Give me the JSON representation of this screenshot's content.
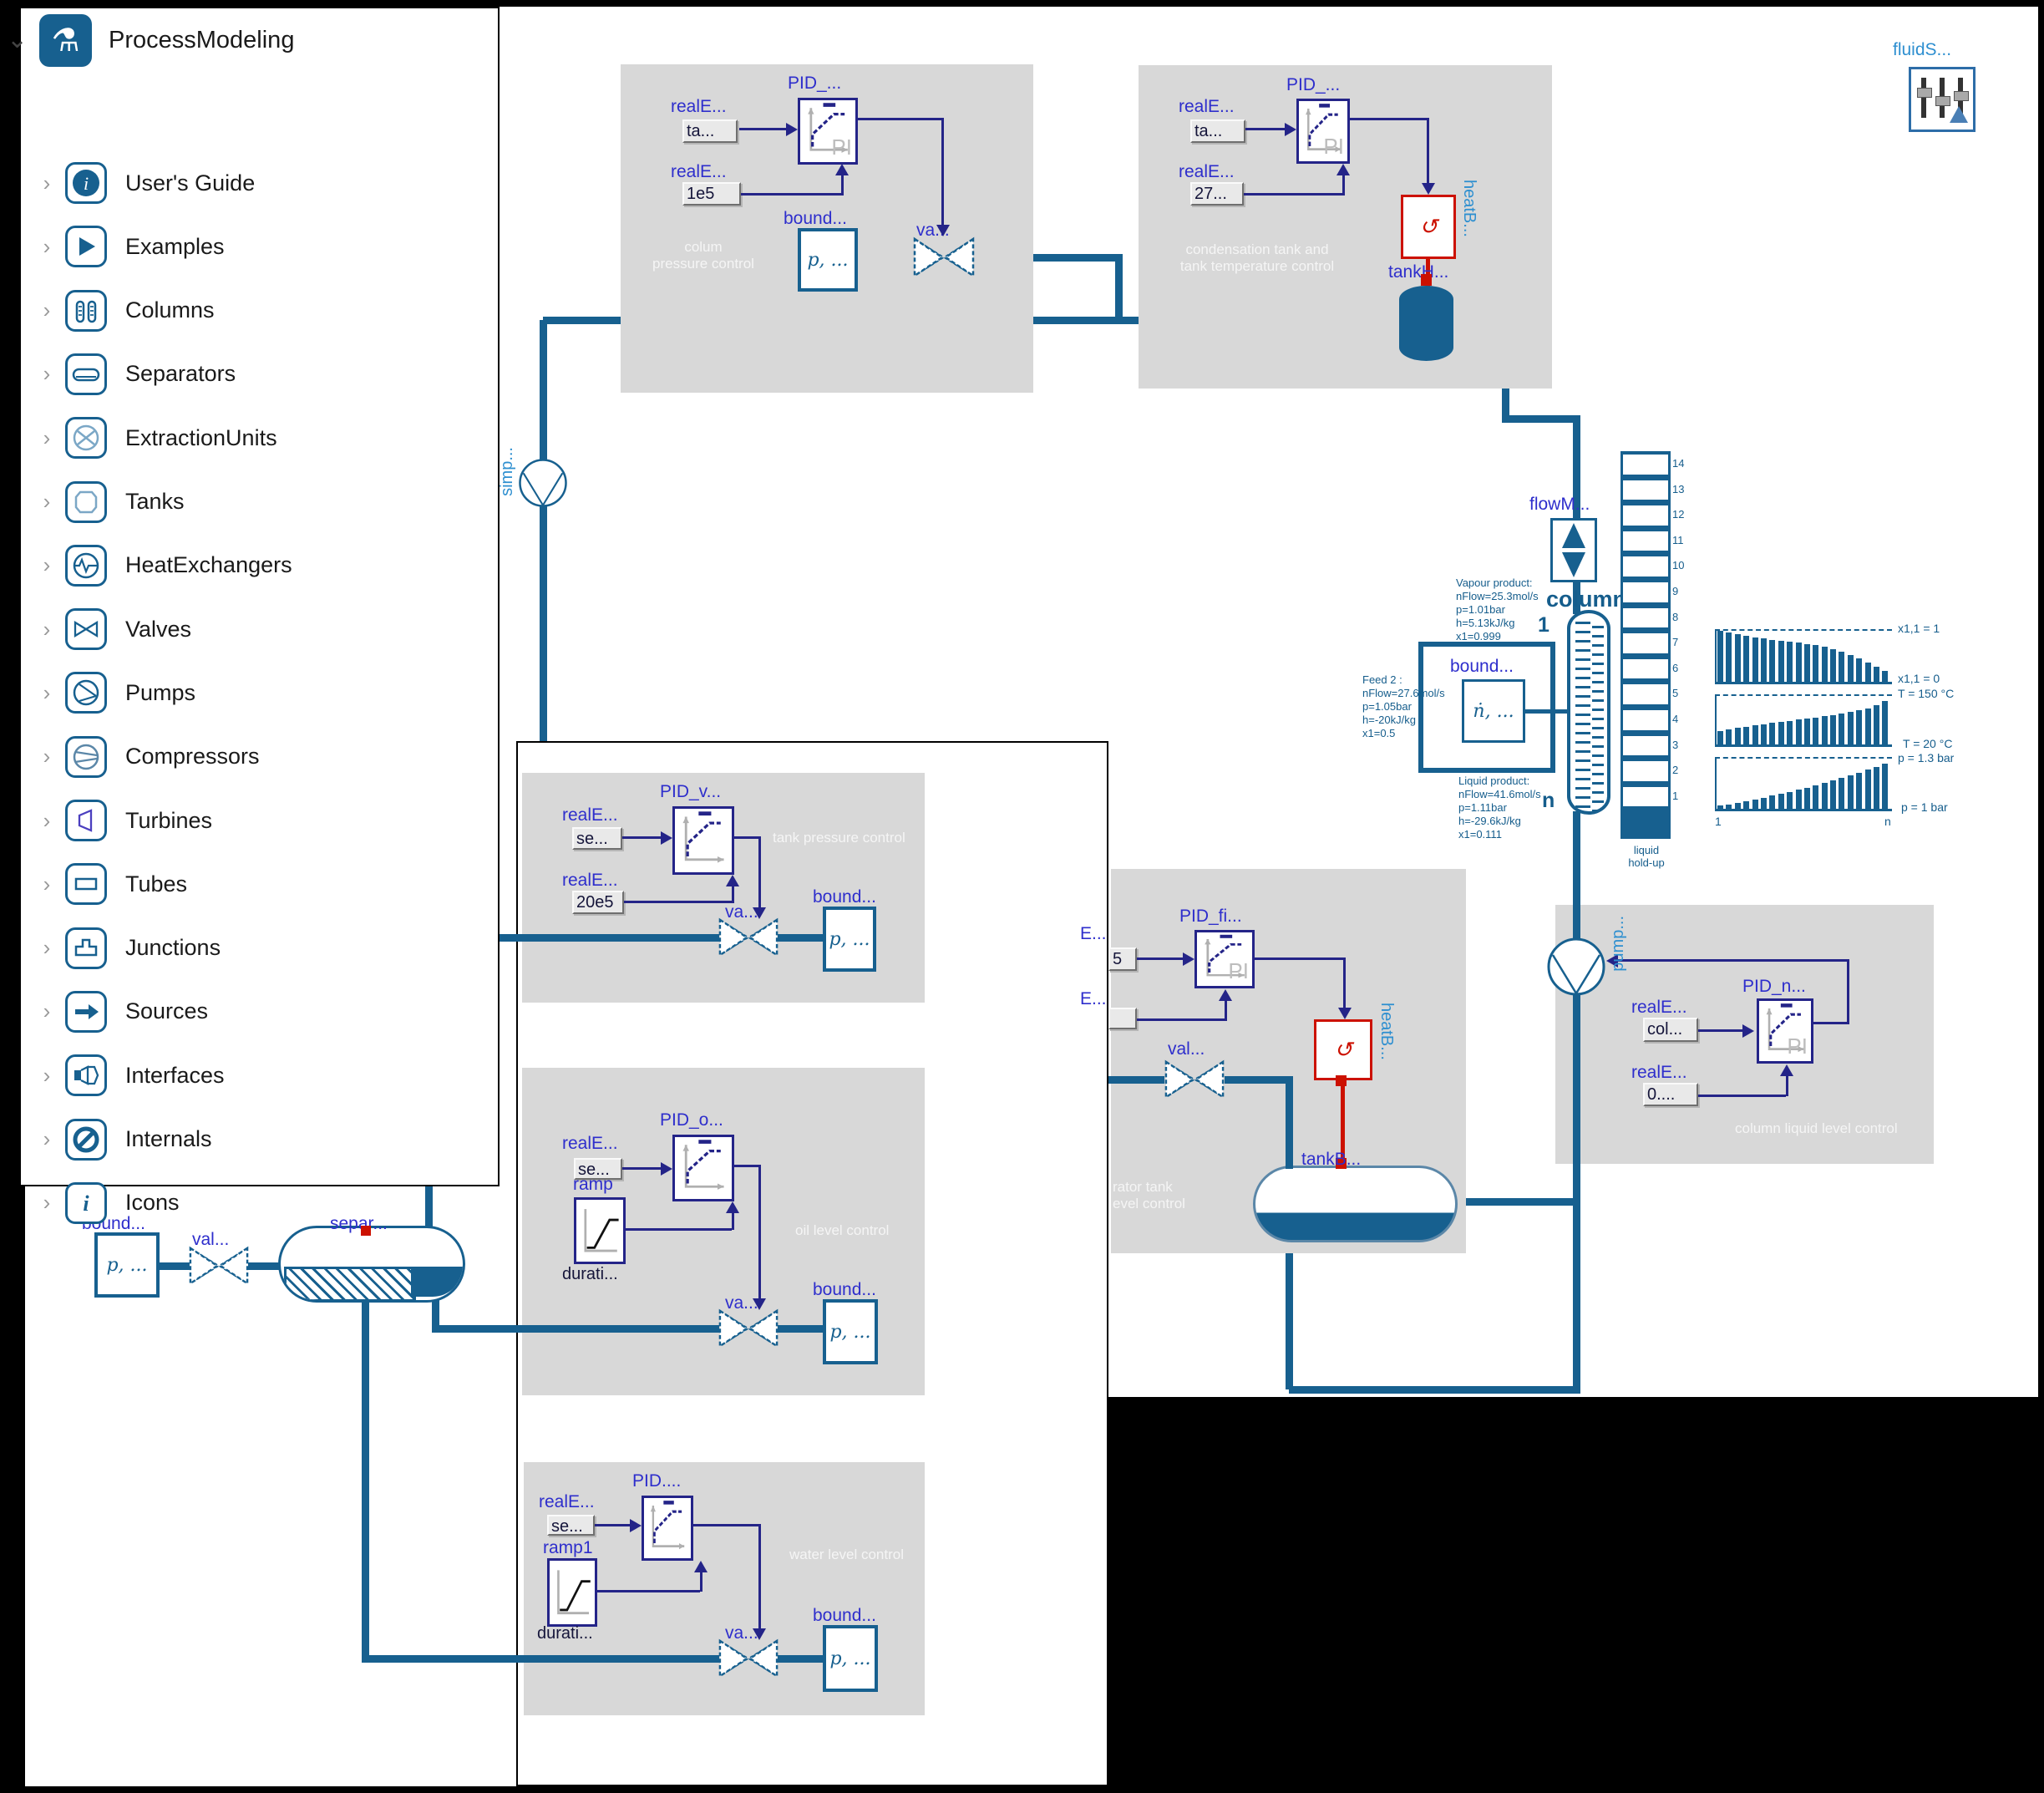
{
  "sidebar": {
    "root_label": "ProcessModeling",
    "items": [
      {
        "label": "User's Guide",
        "icon": "info-icon"
      },
      {
        "label": "Examples",
        "icon": "play-icon"
      },
      {
        "label": "Columns",
        "icon": "columns-icon"
      },
      {
        "label": "Separators",
        "icon": "separator-icon"
      },
      {
        "label": "ExtractionUnits",
        "icon": "extraction-icon"
      },
      {
        "label": "Tanks",
        "icon": "tank-icon"
      },
      {
        "label": "HeatExchangers",
        "icon": "heat-exchanger-icon"
      },
      {
        "label": "Valves",
        "icon": "valve-icon"
      },
      {
        "label": "Pumps",
        "icon": "pump-icon"
      },
      {
        "label": "Compressors",
        "icon": "compressor-icon"
      },
      {
        "label": "Turbines",
        "icon": "turbine-icon"
      },
      {
        "label": "Tubes",
        "icon": "tube-icon"
      },
      {
        "label": "Junctions",
        "icon": "junction-icon"
      },
      {
        "label": "Sources",
        "icon": "source-icon"
      },
      {
        "label": "Interfaces",
        "icon": "interface-icon"
      },
      {
        "label": "Internals",
        "icon": "internal-icon"
      },
      {
        "label": "Icons",
        "icon": "italic-i-icon"
      }
    ]
  },
  "fluid_source": {
    "label": "fluidS..."
  },
  "recycle_pump": {
    "label": "simp..."
  },
  "boxes": {
    "column_pressure": {
      "title_line1": "colum",
      "title_line2": "pressure control",
      "set_label": "realE...",
      "set_value": "ta...",
      "ref_label": "realE...",
      "ref_value": "1e5",
      "pid_label": "PID_...",
      "pid_inner": "PI",
      "bound_label": "bound...",
      "bound_value": "p, ...",
      "valve_label": "va..."
    },
    "condensation": {
      "title_line1": "condensation tank and",
      "title_line2": "tank temperature control",
      "set_label": "realE...",
      "set_value": "ta...",
      "ref_label": "realE...",
      "ref_value": "27...",
      "pid_label": "PID_...",
      "pid_inner": "PI",
      "heater_label": "heatB...",
      "tank_label": "tankH..."
    },
    "tank_pressure": {
      "title": "tank pressure control",
      "set_label": "realE...",
      "set_value": "se...",
      "ref_label": "realE...",
      "ref_value": "20e5",
      "pid_label": "PID_v...",
      "valve_label": "va...",
      "bound_label": "bound...",
      "bound_value": "p, ..."
    },
    "oil_level": {
      "title": "oil level control",
      "set_label": "realE...",
      "set_value": "se...",
      "ramp_label": "ramp",
      "ramp_sub": "durati...",
      "pid_label": "PID_o...",
      "valve_label": "va...",
      "bound_label": "bound...",
      "bound_value": "p, ..."
    },
    "water_level": {
      "title": "water level control",
      "set_label": "realE...",
      "set_value": "se...",
      "ramp_label": "ramp1",
      "ramp_sub": "durati...",
      "pid_label": "PID....",
      "valve_label": "va...",
      "bound_label": "bound...",
      "bound_value": "p, ..."
    },
    "separator_tank": {
      "title_line1": "rator tank",
      "title_line2": "evel control",
      "in1_label": "E...",
      "in1_value": "5",
      "in2_label": "E...",
      "in2_value": "",
      "pid_label": "PID_fi...",
      "pid_inner": "PI",
      "valve_label": "val...",
      "heater_label": "heatB...",
      "tank_label": "tankB..."
    },
    "column_level": {
      "title": "column liquid level control",
      "pump_label": "pump...",
      "set_label": "realE...",
      "set_value": "col...",
      "ref_label": "realE...",
      "ref_value": "0....",
      "pid_label": "PID_n...",
      "pid_inner": "PI"
    }
  },
  "feed_system": {
    "bound_label": "bound...",
    "bound_value": "ṅ, ...",
    "feed_lines": [
      "Feed 2 :",
      "nFlow=27.6mol/s",
      "p=1.05bar",
      "h=-20kJ/kg",
      "x1=0.5"
    ]
  },
  "column": {
    "flow_label": "flowM...",
    "name": "column",
    "top_stage": "1",
    "bottom_stage": "n",
    "holdup_title_1": "liquid",
    "holdup_title_2": "hold-up",
    "stages": [
      14,
      13,
      12,
      11,
      10,
      9,
      8,
      7,
      6,
      5,
      4,
      3,
      2,
      1
    ],
    "vapour_lines": [
      "Vapour product:",
      "nFlow=25.3mol/s",
      "p=1.01bar",
      "h=5.13kJ/kg",
      "x1=0.999"
    ],
    "liquid_lines": [
      "Liquid product:",
      "nFlow=41.6mol/s",
      "p=1.11bar",
      "h=-29.6kJ/kg",
      "x1=0.111"
    ]
  },
  "separator": {
    "bound_label": "bound...",
    "bound_value": "p, ...",
    "valve_label": "val...",
    "name": "separ..."
  },
  "chart_data": [
    {
      "type": "bar",
      "title": "column composition profile",
      "xlabel_left": "1",
      "xlabel_right": "n",
      "top_ref_label": "x1,1 = 1",
      "baseline_label": "x1,1 = 0",
      "ylim": [
        0,
        1
      ],
      "grid": false,
      "values": [
        1.0,
        0.96,
        0.93,
        0.9,
        0.87,
        0.85,
        0.83,
        0.81,
        0.79,
        0.77,
        0.75,
        0.72,
        0.69,
        0.65,
        0.6,
        0.54,
        0.47,
        0.39,
        0.3,
        0.22
      ]
    },
    {
      "type": "bar",
      "title": "column temperature profile",
      "xlabel_left": "1",
      "xlabel_right": "n",
      "top_ref_label": "T = 150 °C",
      "baseline_label": "T = 20 °C",
      "ylim": [
        20,
        150
      ],
      "grid": false,
      "values": [
        0.28,
        0.31,
        0.34,
        0.36,
        0.39,
        0.41,
        0.44,
        0.46,
        0.49,
        0.51,
        0.54,
        0.56,
        0.59,
        0.61,
        0.64,
        0.67,
        0.71,
        0.75,
        0.81,
        0.9
      ]
    },
    {
      "type": "bar",
      "title": "column pressure profile",
      "xlabel_left": "1",
      "xlabel_right": "n",
      "top_ref_label": "p = 1.3 bar",
      "baseline_label": "p = 1  bar",
      "ylim": [
        1.0,
        1.3
      ],
      "grid": false,
      "values": [
        0.06,
        0.09,
        0.12,
        0.15,
        0.19,
        0.22,
        0.26,
        0.3,
        0.34,
        0.38,
        0.42,
        0.46,
        0.51,
        0.56,
        0.61,
        0.66,
        0.72,
        0.78,
        0.84,
        0.9
      ]
    },
    {
      "type": "bar",
      "title": "liquid hold-up per stage",
      "categories": [
        14,
        13,
        12,
        11,
        10,
        9,
        8,
        7,
        6,
        5,
        4,
        3,
        2,
        1
      ],
      "values": [
        1,
        1,
        1,
        1,
        1,
        1,
        1,
        1,
        1,
        1,
        1,
        1,
        1,
        1
      ],
      "note": "equal stacked cells beside column"
    }
  ],
  "colors": {
    "pipe": "#17608f",
    "control_wire": "#242488",
    "instance_label": "#2e2ecc",
    "heat": "#cc1100",
    "box_gray": "#d8d8d8"
  }
}
